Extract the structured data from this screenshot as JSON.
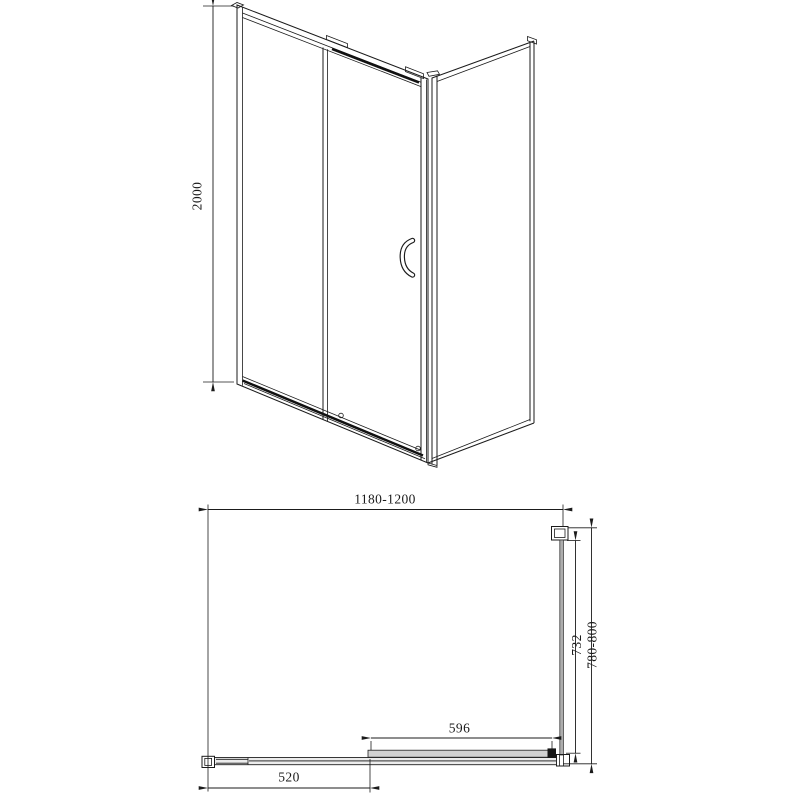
{
  "dims": {
    "height": "2000",
    "width_range": "1180-1200",
    "depth_range": "780-800",
    "glass_depth": "732",
    "door_panel": "596",
    "fixed_panel": "520"
  },
  "colors": {
    "background": "#ffffff",
    "line": "#1b1b1b",
    "glass_gray": "#adadad",
    "panel_gray": "#d2d2d2",
    "track_gray": "#ececec"
  }
}
